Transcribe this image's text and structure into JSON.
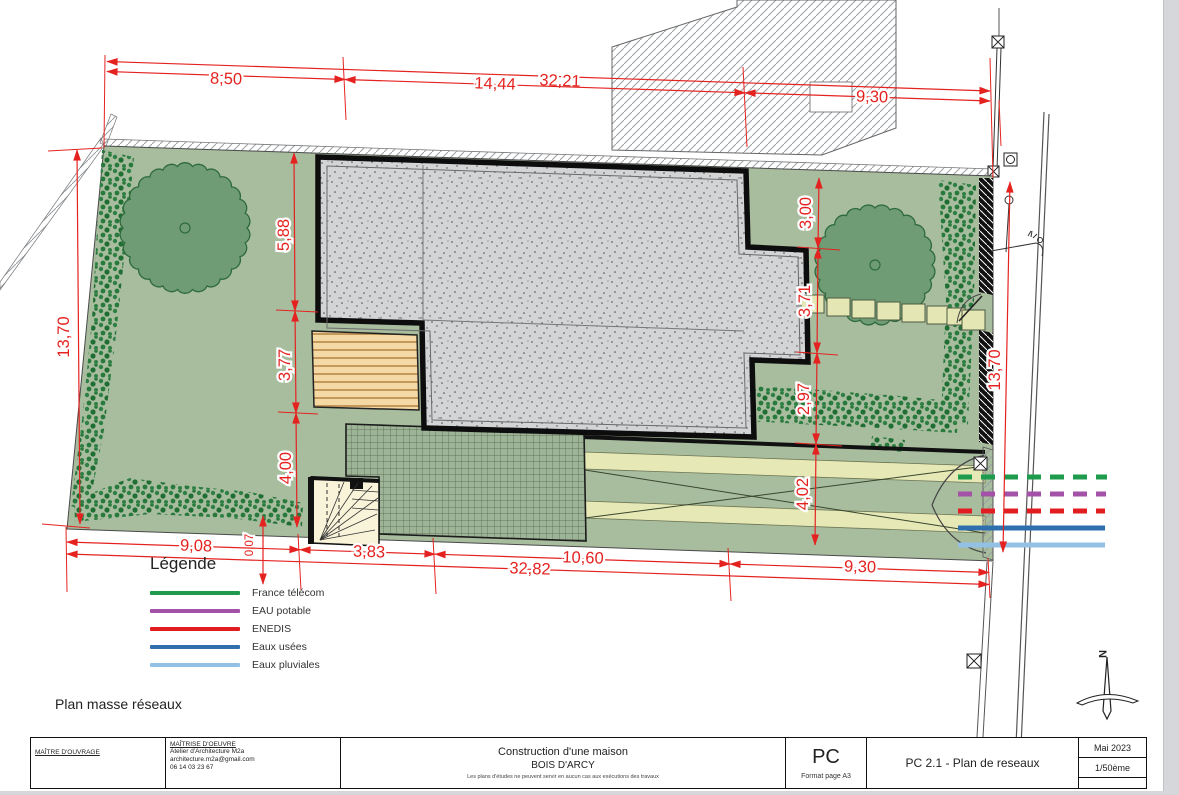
{
  "plan": {
    "label": "Plan masse réseaux",
    "north_label": "N"
  },
  "legend": {
    "title": "Légende",
    "items": [
      {
        "label": "France télécom",
        "color": "#1f9b4d",
        "dashed": true
      },
      {
        "label": "EAU potable",
        "color": "#a452a8",
        "dashed": true
      },
      {
        "label": "ENEDIS",
        "color": "#e21d22",
        "dashed": true
      },
      {
        "label": "Eaux usées",
        "color": "#2f6fae",
        "dashed": false
      },
      {
        "label": "Eaux pluviales",
        "color": "#93c1e6",
        "dashed": false
      }
    ]
  },
  "dims": {
    "top_total": "32,21",
    "top": [
      "8,50",
      "14,44",
      "9,30"
    ],
    "left_height": "13,70",
    "inner_left": [
      "5,88",
      "3,77",
      "4,00"
    ],
    "inner_left_small": "0,07",
    "bottom": [
      "9,08",
      "3,83",
      "10,60",
      "9,30"
    ],
    "bottom_total": "32,82",
    "right_inner": [
      "3,00",
      "3,71",
      "2,97",
      "4,02"
    ],
    "right_height": "13,70"
  },
  "title_block": {
    "maitre_ouvrage_label": "MAÎTRE D'OUVRAGE",
    "maitrise_oeuvre_label": "MAÎTRISE D'OEUVRE",
    "architect": "Atelier d'Architecture M2a",
    "email": "architecture.m2a@gmail.com",
    "phone": "06 14 03 23 67",
    "project_title": "Construction d'une maison",
    "project_city": "BOIS D'ARCY",
    "disclaimer": "Les plans d'études ne peuvent servir en aucun cas aux exécutions des travaux",
    "doc_type": "PC",
    "format": "Format page A3",
    "sheet": "PC 2.1 - Plan de reseaux",
    "date": "Mai 2023",
    "scale": "1/50ème"
  }
}
